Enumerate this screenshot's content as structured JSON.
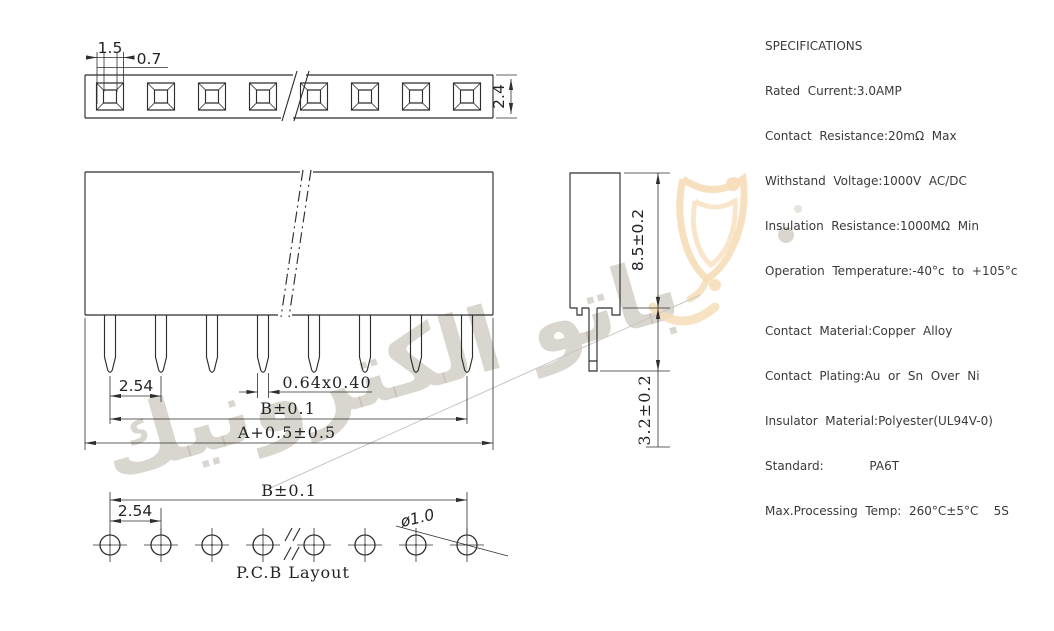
{
  "specifications": {
    "title": "SPECIFICATIONS",
    "electrical": [
      "Rated  Current:3.0AMP",
      "Contact  Resistance:20mΩ  Max",
      "Withstand  Voltage:1000V  AC/DC",
      "Insulation  Resistance:1000MΩ  Min",
      "Operation  Temperature:-40°c  to  +105°c"
    ],
    "material": [
      "Contact  Material:Copper  Alloy",
      "Contact  Plating:Au  or  Sn  Over  Ni",
      "Insulator  Material:Polyester(UL94V-0)",
      "Standard:            PA6T",
      "Max.Processing  Temp:  260°C±5°C    5S"
    ]
  },
  "drawing": {
    "top_view": {
      "hole_size": "1.5",
      "wall": "0.7",
      "strip_height": "2.4"
    },
    "front_view": {
      "pitch": "2.54",
      "pin_section": "0.64x0.40",
      "span": "B±0.1",
      "overall": "A+0.5±0.5"
    },
    "side_view": {
      "body_height": "8.5±0.2",
      "pin_length": "3.2±0.2"
    },
    "pcb_layout": {
      "label": "P.C.B Layout",
      "span": "B±0.1",
      "pitch": "2.54",
      "hole_dia": "ø1.0"
    }
  },
  "watermark": {
    "text": "باتو الكترونيك"
  },
  "colors": {
    "line": "#2e2e2e",
    "watermark_text": "#d5cfc8",
    "watermark_accent": "#f6ddb9"
  }
}
